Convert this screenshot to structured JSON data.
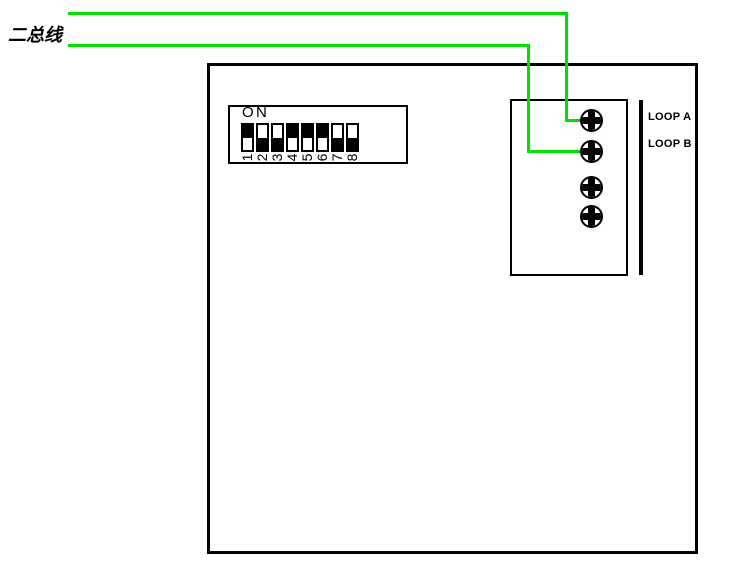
{
  "diagram": {
    "bus_label": "二总线",
    "loop_labels": [
      "LOOP A",
      "LOOP B"
    ],
    "dip_switch": {
      "on_letters": [
        "O",
        "N"
      ],
      "switches": [
        {
          "number": "1",
          "position": "up"
        },
        {
          "number": "2",
          "position": "down"
        },
        {
          "number": "3",
          "position": "down"
        },
        {
          "number": "4",
          "position": "up"
        },
        {
          "number": "5",
          "position": "up"
        },
        {
          "number": "6",
          "position": "up"
        },
        {
          "number": "7",
          "position": "down"
        },
        {
          "number": "8",
          "position": "down"
        }
      ]
    },
    "terminal_block": {
      "screw_count": 4
    },
    "colors": {
      "wire_green": "#00e000",
      "line_black": "#000000"
    }
  }
}
